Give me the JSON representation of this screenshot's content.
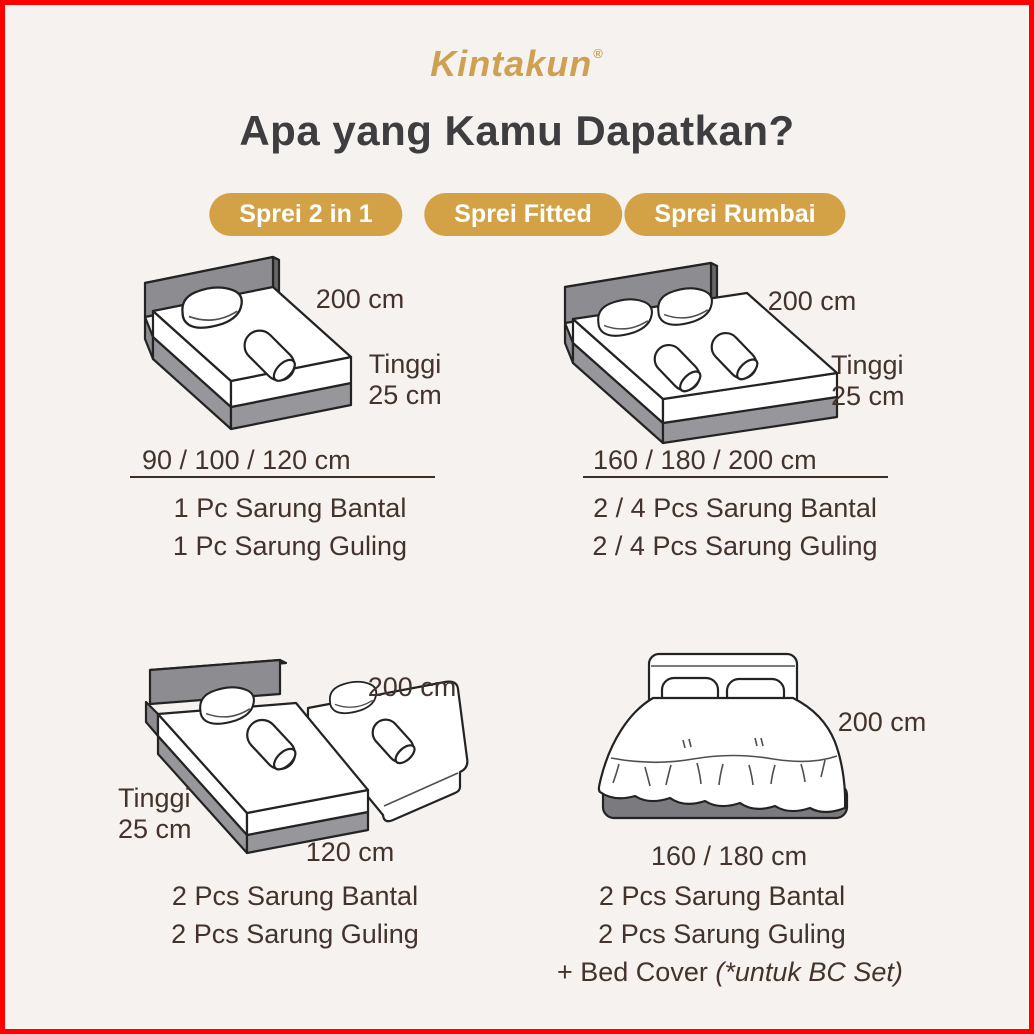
{
  "brand": {
    "logo": "Kintakun",
    "registered": "®"
  },
  "heading": "Apa yang Kamu Dapatkan?",
  "badges": {
    "fitted": "Sprei Fitted",
    "two_in_one": "Sprei 2 in 1",
    "rumbai": "Sprei Rumbai"
  },
  "cells": {
    "fitted_single": {
      "length": "200 cm",
      "height_l1": "Tinggi",
      "height_l2": "25 cm",
      "sizes": "90 / 100 / 120 cm",
      "items": [
        "1 Pc Sarung Bantal",
        "1 Pc Sarung Guling"
      ]
    },
    "fitted_double": {
      "length": "200 cm",
      "height_l1": "Tinggi",
      "height_l2": "25 cm",
      "sizes": "160 / 180 / 200 cm",
      "items": [
        "2 / 4 Pcs Sarung Bantal",
        "2 / 4 Pcs Sarung Guling"
      ]
    },
    "two_in_one": {
      "length": "200 cm",
      "height_l1": "Tinggi",
      "height_l2": "25 cm",
      "width": "120 cm",
      "items": [
        "2 Pcs Sarung Bantal",
        "2 Pcs Sarung Guling"
      ]
    },
    "rumbai": {
      "length": "200 cm",
      "sizes": "160 / 180 cm",
      "items": [
        "2 Pcs Sarung Bantal",
        "2 Pcs Sarung Guling"
      ],
      "extra_prefix": "+ Bed Cover ",
      "extra_note": "(*untuk BC Set)"
    }
  },
  "colors": {
    "background": "#F5F2EF",
    "frame_border": "#FF0000",
    "accent_gold": "#D3A246",
    "logo_gold": "#CEA052",
    "heading_text": "#3E3D40",
    "body_text": "#44332C",
    "badge_text": "#FFFFFF",
    "bed_gray": "#8C8C91"
  },
  "illustrations": {
    "fitted_single": "single-bed-isometric",
    "fitted_double": "double-bed-isometric",
    "two_in_one": "bed-with-trundle-isometric",
    "rumbai": "ruffled-bed-front-view"
  }
}
